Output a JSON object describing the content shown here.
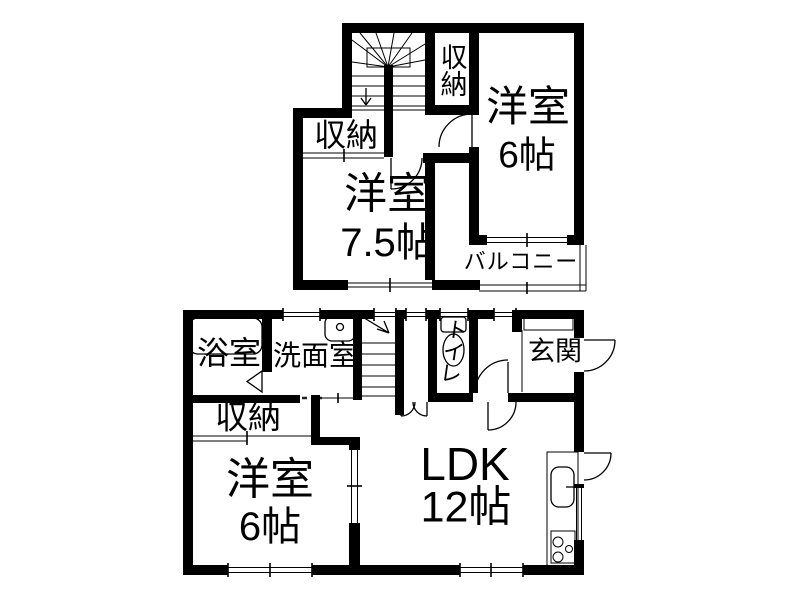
{
  "title": "2-story house floor plan",
  "colors": {
    "wall": "#000000",
    "background": "#ffffff",
    "line": "#000000"
  },
  "floor2": {
    "closet_upper": "収納",
    "bedroom6_name": "洋室",
    "bedroom6_size": "6帖",
    "closet_left": "収納",
    "bedroom75_name": "洋室",
    "bedroom75_size": "7.5帖",
    "balcony": "バルコニー"
  },
  "floor1": {
    "bathroom": "浴室",
    "washroom": "洗面室",
    "toilet": "トイレ",
    "entrance": "玄関",
    "closet": "収納",
    "bedroom6_name": "洋室",
    "bedroom6_size": "6帖",
    "ldk_name": "LDK",
    "ldk_size": "12帖"
  }
}
